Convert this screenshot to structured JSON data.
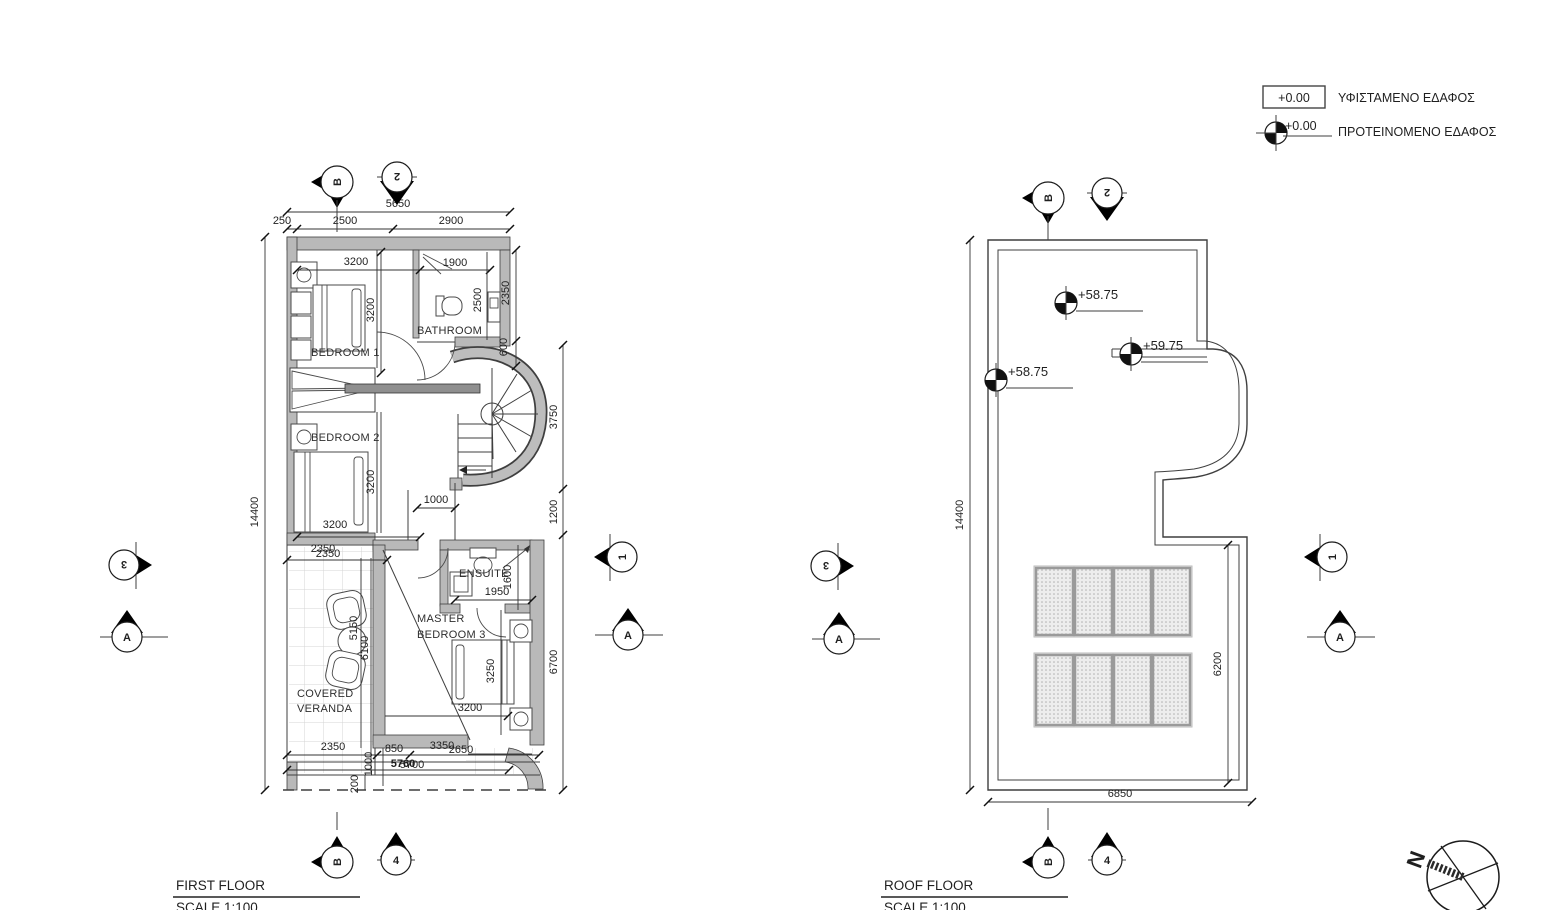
{
  "legend": {
    "existing": {
      "value": "+0.00",
      "label": "ΥΦΙΣΤΑΜΕΝΟ ΕΔΑΦΟΣ"
    },
    "proposed": {
      "value": "+0.00",
      "label": "ΠΡΟΤΕΙΝΟΜΕΝΟ ΕΔΑΦΟΣ"
    }
  },
  "ff": {
    "title": "FIRST FLOOR",
    "scale": "SCALE 1:100",
    "rooms": {
      "bedroom1": "BEDROOM 1",
      "bedroom2": "BEDROOM 2",
      "bathroom": "BATHROOM",
      "ensuite": "ENSUITE",
      "master1": "MASTER",
      "master2": "BEDROOM 3",
      "veranda1": "COVERED",
      "veranda2": "VERANDA"
    },
    "dims": {
      "w5650": "5650",
      "w250": "250",
      "w2500": "2500",
      "w2900": "2900",
      "b1w": "3200",
      "b1h": "3200",
      "bathdoor": "1900",
      "bathh": "2500",
      "r2350": "2350",
      "r600": "600",
      "r3750": "3750",
      "r1200": "1200",
      "r6700": "6700",
      "h14400": "14400",
      "b2h": "3200",
      "b2w": "3200",
      "hall1000": "1000",
      "v2350a": "2350",
      "v2350b": "2350",
      "v5150": "5150",
      "v6100": "6100",
      "e1600": "1600",
      "e1950": "1950",
      "m3250": "3250",
      "m3200": "3200",
      "bt2350": "2350",
      "bt850": "850",
      "bt3350": "3350",
      "bt2650": "2650",
      "bt5760": "5760",
      "bt5700": "5700",
      "bt1000": "1000",
      "bt200": "200"
    }
  },
  "rf": {
    "title": "ROOF FLOOR",
    "scale": "SCALE 1:100",
    "levels": {
      "l1": "+58.75",
      "l2": "+59.75",
      "l3": "+58.75"
    },
    "dims": {
      "h14400": "14400",
      "w6850": "6850",
      "i6200": "6200"
    }
  },
  "markers": {
    "b": "B",
    "two": "2",
    "three": "3",
    "one": "1",
    "a": "A",
    "four": "4",
    "north": "N"
  }
}
